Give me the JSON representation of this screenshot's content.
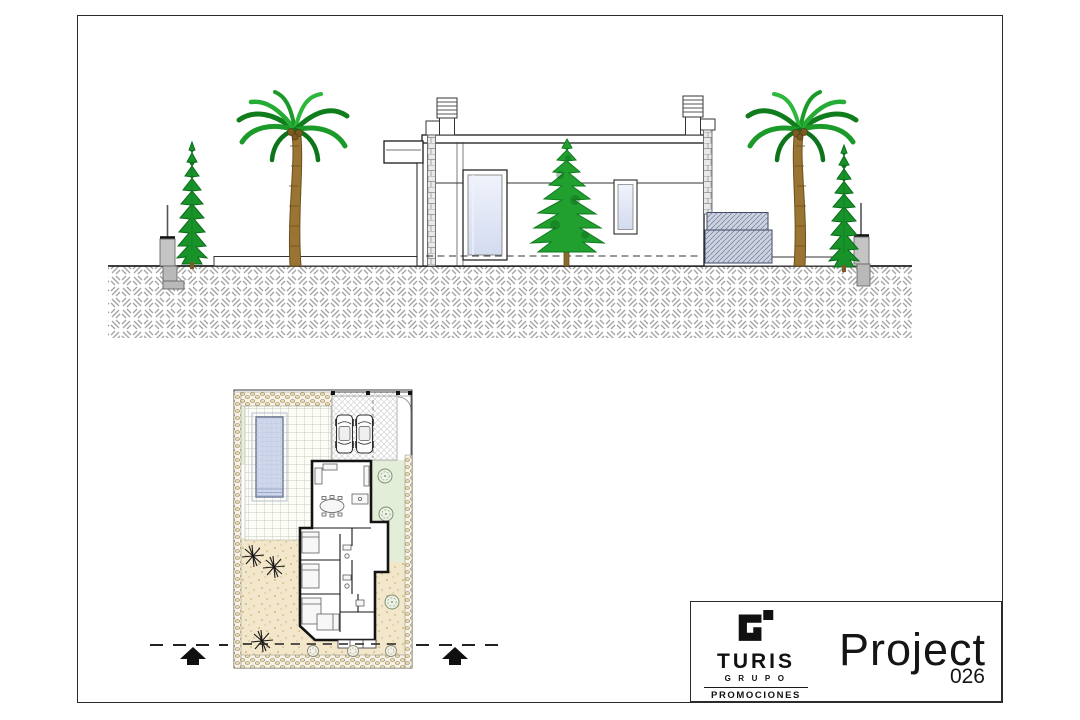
{
  "title_block": {
    "company": "TURIS",
    "group": "GRUPO",
    "division": "PROMOCIONES",
    "project_label": "Project",
    "project_number": "026",
    "logo_icon": "turis-g-logo"
  },
  "colors": {
    "line": "#1a1a1a",
    "glass_blue": "#dce3f3",
    "pool_blue": "#cfd7ea",
    "lawn_green": "#e7efda",
    "garden_green": "#e3eed9",
    "sand_beige": "#f3e7cb",
    "palm_green": "#1c9a29",
    "trunk_brown": "#9a7433",
    "ground_hatch_gray": "#a2a2a2",
    "section_steps_gray": "#ccd2e0"
  }
}
